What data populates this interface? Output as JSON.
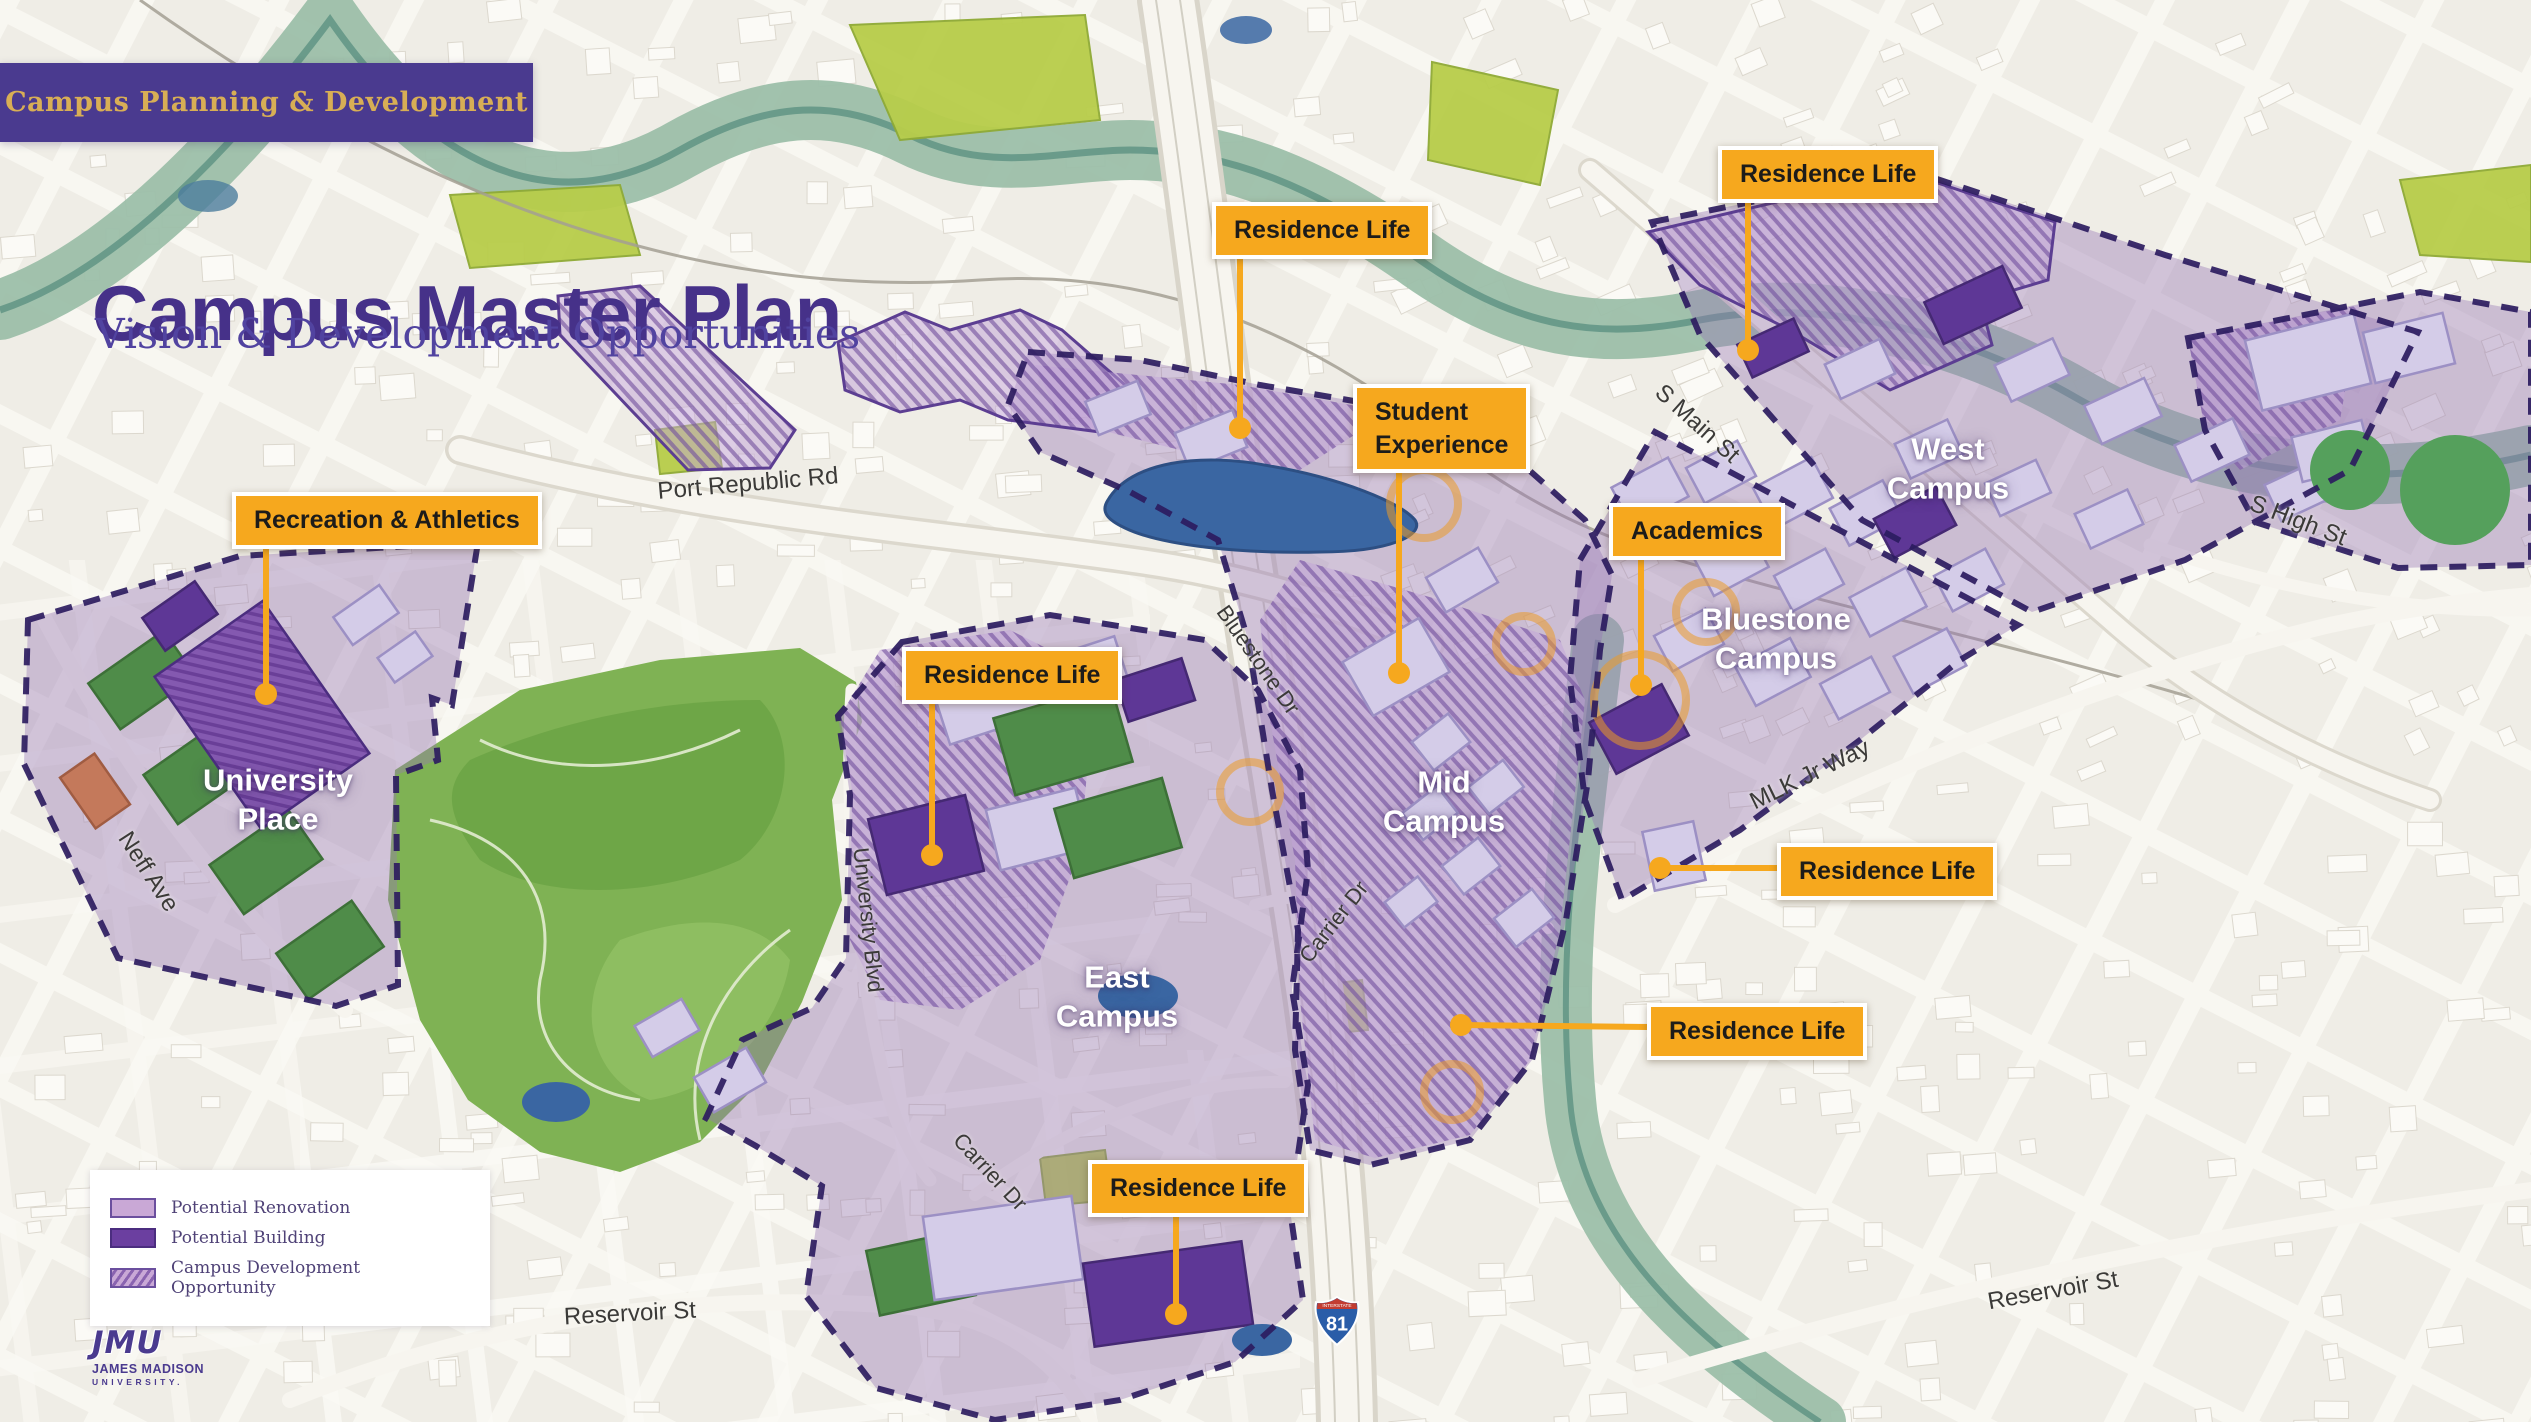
{
  "header": {
    "badge": "Campus Planning & Development",
    "title": "Campus Master Plan",
    "subtitle": "Vision & Development Opportunities"
  },
  "callouts": [
    {
      "id": "recreation-athletics",
      "label": "Recreation & Athletics"
    },
    {
      "id": "residence-life-pond",
      "label": "Residence Life"
    },
    {
      "id": "residence-life-main-st",
      "label": "Residence Life"
    },
    {
      "id": "student-experience",
      "label": "Student\nExperience"
    },
    {
      "id": "academics",
      "label": "Academics"
    },
    {
      "id": "residence-life-east",
      "label": "Residence Life"
    },
    {
      "id": "residence-life-mlk",
      "label": "Residence Life"
    },
    {
      "id": "residence-life-hillside",
      "label": "Residence Life"
    },
    {
      "id": "residence-life-south",
      "label": "Residence Life"
    }
  ],
  "campus_labels": [
    {
      "id": "university-place",
      "label": "University\nPlace"
    },
    {
      "id": "west-campus",
      "label": "West\nCampus"
    },
    {
      "id": "bluestone-campus",
      "label": "Bluestone\nCampus"
    },
    {
      "id": "mid-campus",
      "label": "Mid\nCampus"
    },
    {
      "id": "east-campus",
      "label": "East\nCampus"
    }
  ],
  "street_labels": [
    "Port Republic Rd",
    "Neff Ave",
    "S Main St",
    "S High St",
    "MLK Jr Way",
    "Bluestone Dr",
    "Carrier Dr",
    "University Blvd",
    "Carrier Dr",
    "Reservoir St",
    "Reservoir St"
  ],
  "legend": {
    "items": [
      {
        "label": "Potential Renovation",
        "swatch": "renovation"
      },
      {
        "label": "Potential Building",
        "swatch": "building"
      },
      {
        "label": "Campus Development Opportunity",
        "swatch": "development"
      }
    ]
  },
  "logo": {
    "acronym": "JMU",
    "line1": "JAMES MADISON",
    "line2": "UNIVERSITY."
  },
  "highway_shield": {
    "system": "INTERSTATE",
    "number": "81"
  },
  "colors": {
    "accent_orange": "#f6a81e",
    "brand_purple": "#4a3a8f",
    "title_purple": "#463189",
    "district_purple": "#9775b5",
    "boundary_dash": "#2c1c60",
    "pond_blue": "#3a66a2",
    "park_green": "#7fb254"
  }
}
